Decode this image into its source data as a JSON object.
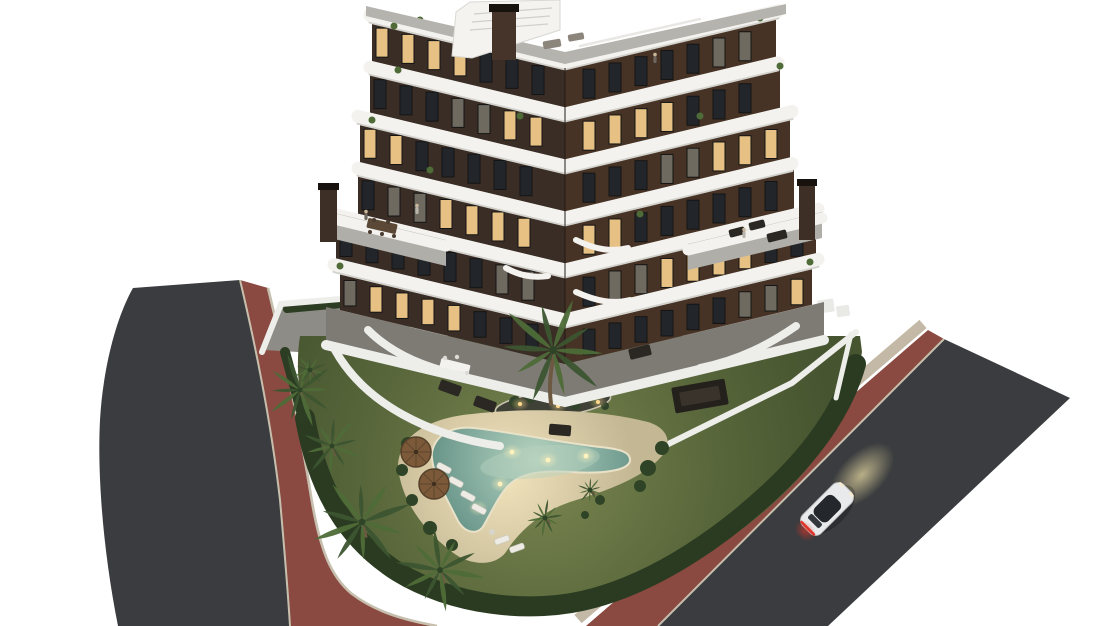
{
  "scene": {
    "w": 1110,
    "h": 626,
    "background": "#ffffff",
    "colors": {
      "asphalt": "#3a3c3f",
      "bike_path": "#8a4a41",
      "curb": "#c7bfae",
      "sidewalk": "#c3b9a6",
      "lawn_light": "#7a8650",
      "lawn_mid": "#5a683c",
      "lawn_dark": "#465430",
      "hedge": "#2a3b21",
      "hedge2": "#2c3d23",
      "sand_light": "#f1e3bc",
      "sand_dark": "#c3b794",
      "water_light": "#b7d2be",
      "water_mid": "#8fb5a6",
      "water_dark": "#5f8d82",
      "pool_rim": "#e9e2c9",
      "facade_left": "#3a2d25",
      "facade_right": "#463325",
      "band_white": "#f3f2ee",
      "band_shadow": "#d2d1cc",
      "window_lit": "#e6c183",
      "window_dark": "#22262b",
      "window_half": "#6e6a60",
      "window_frame": "#141414",
      "paving": "#7e7b75",
      "terrace_deck": "#b0aea8",
      "roof_deck": "#b5b3ae",
      "wall_white": "#ededea",
      "patio": "#8e8c86",
      "palm_dark": "#3c5530",
      "palm_light": "#4e6b38",
      "trunk": "#6d5942",
      "bush": "#2f4426",
      "island_soil": "#3f4136",
      "island_bush": "#31432a",
      "umbrella": "#7c5a39",
      "umbrella_rim": "#55402a",
      "lounger": "#edebe4",
      "furn_dark": "#2b2722",
      "table_wood": "#5b4836",
      "chimney": "#3e2f26",
      "chimney_cap": "#17120e",
      "car_body": "#e9eaec",
      "car_trim": "#c2c3c6",
      "car_glass": "#24272b",
      "car_tail": "#e03428",
      "glow_warm": "#efe0a6",
      "light_dot": "#ffd98f",
      "pool_light": "#fff2bd",
      "figure_body": "#b9b4ac",
      "figure_body2": "#6f675e",
      "figure_head": "#c9b59a"
    },
    "left_road": {
      "asphalt": "M133,288 L240,280 C258,356 272,430 280,500 C285,556 288,594 290,626 L118,626 C104,556 97,478 100,420 C103,368 116,318 133,288 Z",
      "red": "M240,280 L268,288 C288,368 302,440 312,502 C320,548 330,576 352,594 C376,612 404,620 437,626 L290,626 C288,594 285,556 280,500 C272,430 258,356 240,280 Z",
      "curb_outer": "M240,280 C258,356 272,430 280,500 C285,556 288,594 290,626",
      "curb_inner": "M268,288 C288,368 302,440 312,502 C320,548 330,576 352,594 C376,612 404,620 437,626"
    },
    "right_road": {
      "sidewalk": "M578,619 L923,324",
      "red": "M586,626 L928,330 L944,339 L658,626 Z",
      "asphalt": "M658,626 L944,339 L1070,398 L828,626 Z",
      "curb": "M658,626 L944,339"
    },
    "patio_nw": {
      "deck": [
        [
          264,
          350
        ],
        [
          282,
          306
        ],
        [
          420,
          294
        ],
        [
          452,
          312
        ],
        [
          332,
          354
        ]
      ],
      "wall": "M262,352 L281,304 L424,292",
      "hedge": "M287,309 L418,297"
    },
    "right_wall": {
      "wall": "M640,458 L792,383 L856,332",
      "wall2": "M851,334 L836,398",
      "boxes": [
        [
          826,
          306,
          16,
          13,
          -8
        ],
        [
          843,
          311,
          13,
          11,
          -8
        ]
      ]
    },
    "lawn": {
      "d": "M300,336 L860,336 L862,352 C854,396 838,432 806,470 C768,514 716,552 664,576 C620,596 566,606 520,602 C462,597 404,572 364,534 C332,504 314,462 304,420 C298,390 296,360 300,336 Z",
      "hedge_main": "M305,418 C318,492 348,540 398,572 C450,604 530,616 594,598 C660,580 726,534 776,486 C818,446 845,404 856,364",
      "hedge_left": "M285,352 L303,418"
    },
    "island": {
      "cx": 553,
      "cy": 404,
      "rx": 58,
      "ry": 13,
      "rot": -7,
      "bushes": [
        [
          515,
          402,
          6
        ],
        [
          530,
          398,
          5
        ],
        [
          575,
          404,
          6
        ],
        [
          595,
          400,
          5
        ],
        [
          605,
          406,
          4
        ]
      ],
      "lights": [
        [
          520,
          404
        ],
        [
          558,
          406
        ],
        [
          598,
          402
        ]
      ]
    },
    "beach": {
      "sand": "M398,468 C398,436 428,418 472,414 C530,407 602,410 648,422 C668,428 674,444 660,458 C640,480 602,492 570,502 C541,512 520,530 506,552 C495,567 470,566 452,552 C421,528 402,500 398,468 Z",
      "glow": [
        475,
        475,
        65,
        38
      ],
      "bushes": [
        [
          408,
          444,
          7
        ],
        [
          402,
          470,
          6
        ],
        [
          412,
          500,
          6
        ],
        [
          430,
          528,
          7
        ],
        [
          452,
          545,
          6
        ],
        [
          648,
          468,
          8
        ],
        [
          662,
          448,
          7
        ],
        [
          640,
          486,
          6
        ],
        [
          600,
          500,
          5
        ],
        [
          585,
          515,
          4
        ]
      ],
      "umbrellas": [
        [
          416,
          452
        ],
        [
          434,
          484
        ]
      ],
      "loungers": [
        [
          444,
          468,
          28
        ],
        [
          456,
          482,
          28
        ],
        [
          468,
          496,
          28
        ],
        [
          479,
          509,
          28
        ],
        [
          502,
          540,
          -20
        ],
        [
          517,
          548,
          -20
        ]
      ],
      "side_table": [
        492,
        532
      ]
    },
    "pool": {
      "water": "M432,452 C436,433 454,426 474,428 C512,432 562,443 600,447 C620,449 631,452 630,461 C628,471 601,474 571,472 C542,470 521,473 509,485 C499,495 491,513 484,525 C478,536 465,533 458,521 C447,499 430,470 432,452 Z",
      "inner_glow": [
        540,
        462,
        60,
        16,
        -6
      ],
      "lights": [
        [
          512,
          452
        ],
        [
          548,
          460
        ],
        [
          586,
          456
        ],
        [
          500,
          484
        ],
        [
          478,
          508
        ]
      ]
    },
    "ground_level": {
      "paving": [
        [
          326,
          307
        ],
        [
          565,
          364
        ],
        [
          824,
          302
        ],
        [
          824,
          340
        ],
        [
          565,
          402
        ],
        [
          326,
          345
        ]
      ],
      "wall_band": "M326,345 L565,402 L824,340",
      "walls": [
        "M368,330 C390,352 420,366 456,374",
        "M700,368 C740,360 770,344 796,326",
        "M335,350 C365,404 430,436 500,446"
      ],
      "tables": [
        [
          600,
          318,
          -12
        ],
        [
          455,
          366,
          14
        ]
      ],
      "lounges": [
        [
          450,
          388,
          20
        ],
        [
          485,
          404,
          20
        ],
        [
          560,
          430,
          5
        ],
        [
          640,
          352,
          -14
        ]
      ],
      "pergola": [
        700,
        396,
        54,
        26,
        -10
      ]
    },
    "building": {
      "cx": 565,
      "slope": 0.24,
      "band_w": 13,
      "bands": [
        {
          "c": 62,
          "L": 370,
          "R": 778
        },
        {
          "c": 114,
          "L": 370,
          "R": 778
        },
        {
          "c": 166,
          "L": 358,
          "R": 792
        },
        {
          "c": 218,
          "L": 358,
          "R": 792
        },
        {
          "c": 270,
          "L": 334,
          "R": 818
        },
        {
          "c": 320,
          "L": 334,
          "R": 818
        }
      ],
      "facades": [
        {
          "t": 68.5,
          "b": 107.5,
          "L": 372,
          "R": 776
        },
        {
          "t": 120.5,
          "b": 159.5,
          "L": 370,
          "R": 780
        },
        {
          "t": 172.5,
          "b": 211.5,
          "L": 360,
          "R": 790
        },
        {
          "t": 224.5,
          "b": 263.5,
          "L": 358,
          "R": 794
        },
        {
          "t": 276.5,
          "b": 315.5,
          "L": 336,
          "R": 816
        },
        {
          "t": 328.5,
          "b": 364,
          "L": 340,
          "R": 812
        }
      ],
      "windows": {
        "w": 12,
        "gap": 26,
        "inset": 5
      },
      "corner_shadow": "M565,68 L565,364",
      "balcony_curves": [
        "M576,240 C596,250 612,252 628,248",
        "M576,292 C598,302 614,304 630,300",
        "M506,268 C520,276 534,278 548,276"
      ],
      "plants": [
        [
          394,
          26
        ],
        [
          420,
          20
        ],
        [
          760,
          18
        ],
        [
          398,
          70
        ],
        [
          372,
          120
        ],
        [
          780,
          66
        ],
        [
          700,
          116
        ],
        [
          340,
          266
        ],
        [
          810,
          262
        ],
        [
          430,
          170
        ],
        [
          640,
          214
        ],
        [
          520,
          116
        ]
      ],
      "terrace_left": {
        "deck": [
          [
            326,
            211
          ],
          [
            446,
            240
          ],
          [
            446,
            266
          ],
          [
            326,
            237
          ]
        ],
        "parapet": "M326,217 L446,246",
        "chimney": [
          320,
          188,
          17,
          54
        ],
        "table": [
          382,
          226,
          30,
          10,
          13
        ],
        "figures": [
          [
            366,
            215
          ],
          [
            417,
            209
          ]
        ]
      },
      "terrace_right": {
        "deck": [
          [
            688,
            244
          ],
          [
            822,
            212
          ],
          [
            822,
            238
          ],
          [
            688,
            270
          ]
        ],
        "parapet": "M688,250 L822,218",
        "chimney": [
          799,
          184,
          16,
          56
        ],
        "sofas": [
          [
            737,
            232,
            16,
            8,
            -14
          ],
          [
            757,
            225,
            16,
            8,
            -14
          ],
          [
            777,
            236,
            20,
            9,
            -14
          ]
        ],
        "figures": [
          [
            744,
            233
          ]
        ]
      },
      "roof": {
        "deck": [
          [
            366,
            16
          ],
          [
            565,
            64
          ],
          [
            786,
            14
          ],
          [
            786,
            4
          ],
          [
            565,
            52
          ],
          [
            366,
            6
          ]
        ],
        "stair": [
          [
            452,
            56
          ],
          [
            456,
            12
          ],
          [
            470,
            2
          ],
          [
            560,
            0
          ],
          [
            560,
            30
          ],
          [
            472,
            58
          ]
        ],
        "steps": [
          "M474,14 L552,8",
          "M472,22 L550,16",
          "M470,30 L548,24"
        ],
        "chimney": [
          492,
          10,
          24,
          50
        ],
        "cap": [
          489,
          4,
          30,
          8
        ],
        "rail": "M580,46 L700,19",
        "sofas": [
          [
            552,
            44,
            18,
            8,
            -10
          ],
          [
            576,
            37,
            16,
            7,
            -10
          ]
        ],
        "figures": [
          [
            655,
            58
          ]
        ]
      }
    },
    "palms": [
      [
        300,
        390,
        36
      ],
      [
        332,
        446,
        30
      ],
      [
        362,
        522,
        48
      ],
      [
        440,
        570,
        42
      ],
      [
        553,
        350,
        54
      ],
      [
        545,
        518,
        18
      ],
      [
        590,
        490,
        13
      ],
      [
        310,
        370,
        16
      ]
    ],
    "island_palm_trunk": "M551,404 C549,388 550,372 554,356",
    "car": {
      "x": 827,
      "y": 509,
      "angle": -45,
      "glow": [
        862,
        475,
        40,
        22
      ]
    }
  }
}
